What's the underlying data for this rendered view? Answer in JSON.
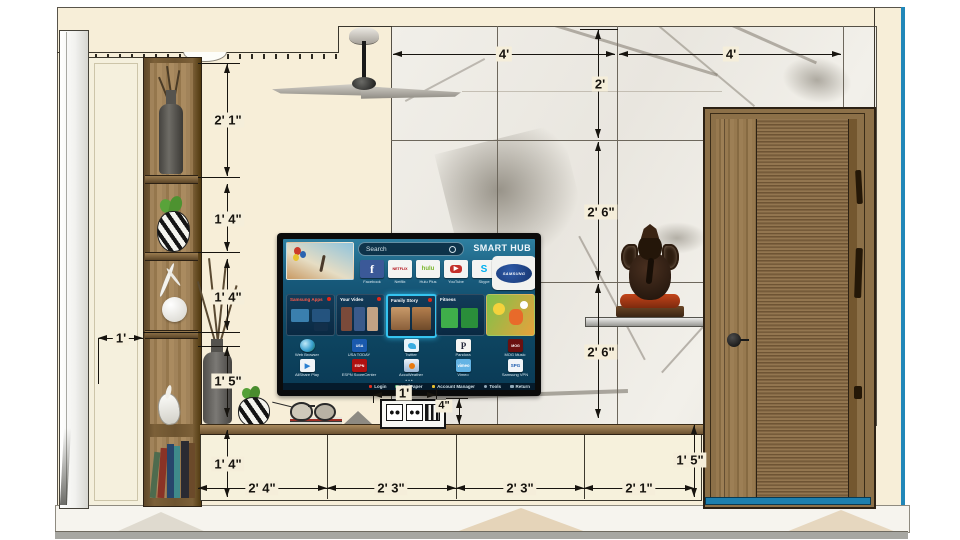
{
  "dims": {
    "marble_top_left": "4'",
    "marble_top_right": "4'",
    "marble_col_top": "2'",
    "marble_col_mid": "2' 6\"",
    "marble_col_bottom": "2' 6\"",
    "shelf_top": "2' 1\"",
    "shelf_second": "1' 4\"",
    "shelf_third": "1' 4\"",
    "shelf_fourth": "1' 5\"",
    "side_depth": "1'",
    "base_left_height": "1' 4\"",
    "base_seg1": "2' 4\"",
    "base_seg2": "2' 3\"",
    "base_seg3": "2' 3\"",
    "base_seg4": "2' 1\"",
    "base_right_height": "1' 5\"",
    "switch_width": "1'",
    "switch_height": "4\""
  },
  "tv": {
    "search_placeholder": "Search",
    "brand": "SMART HUB",
    "logo_text": "SAMSUNG",
    "pager_dots": "• • •",
    "app_tiles": [
      {
        "label": "Facebook",
        "glyph": "f"
      },
      {
        "label": "Netflix",
        "glyph": "NETFLIX"
      },
      {
        "label": "Hulu Plus",
        "glyph": "hulu"
      },
      {
        "label": "YouTube",
        "glyph": "▶"
      },
      {
        "label": "Skype",
        "glyph": "S"
      }
    ],
    "cards": [
      {
        "title": "Samsung Apps"
      },
      {
        "title": "Your Video"
      },
      {
        "title": "Family Story"
      },
      {
        "title": "Fitness"
      },
      {
        "title": ""
      }
    ],
    "app_row2": [
      {
        "label": "Web Browser",
        "glyph": ""
      },
      {
        "label": "USA TODAY",
        "glyph": "USA"
      },
      {
        "label": "Twitter",
        "glyph": ""
      },
      {
        "label": "Pandora",
        "glyph": "P"
      },
      {
        "label": "MOG Music",
        "glyph": "MOG"
      }
    ],
    "app_row3": [
      {
        "label": "AllShare Play",
        "glyph": "▶"
      },
      {
        "label": "ESPN ScoreCenter",
        "glyph": "ESPN"
      },
      {
        "label": "AccuWeather",
        "glyph": ""
      },
      {
        "label": "Vimeo",
        "glyph": "vimeo"
      },
      {
        "label": "Samsung VPN",
        "glyph": "SPG"
      }
    ],
    "footer": [
      {
        "label": "Login"
      },
      {
        "label": "WallPaper"
      },
      {
        "label": "Account Manager"
      },
      {
        "label": "Tools"
      },
      {
        "label": "Return"
      }
    ]
  },
  "colors": {
    "wall": "#f7eed8",
    "wood": "#8a6d45",
    "door_wood": "#8f744c",
    "marble_base": "#efede8",
    "edge_blue": "#2187b8",
    "tv_screen_blue": "#10506e",
    "highlight_cyan": "#35c4f0",
    "statue_orange": "#b43a12",
    "dim_ink": "#17140f"
  }
}
